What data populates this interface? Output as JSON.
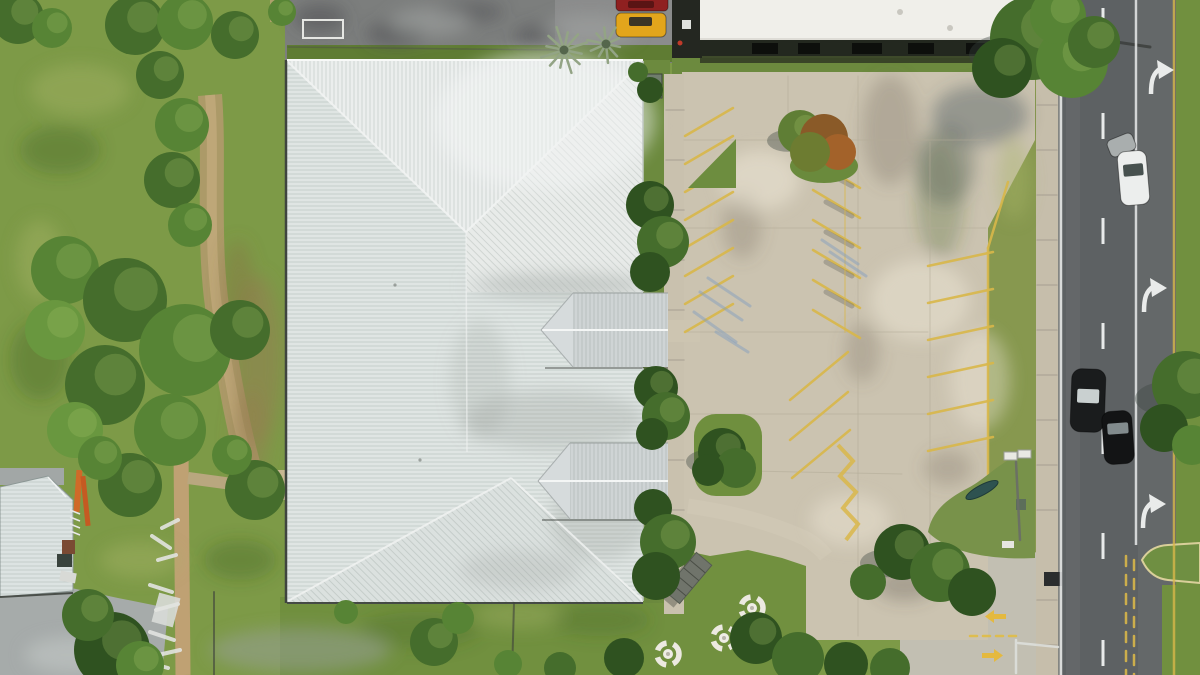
{
  "scene": {
    "colors": {
      "grass_field": "#7d9a47",
      "grass_verge": "#87984f",
      "grass_island": "#6f8f3e",
      "tree_dark": "#2f5220",
      "tree_mid": "#456d2c",
      "tree_light": "#69973f",
      "tree_rust": "#8a5a28",
      "roof_metal": "#dfe5e3",
      "roof_dormer": "#cfd4d5",
      "roof_left_building": "#dce3e2",
      "building_white": "#f0efea",
      "concrete_lot": "#cbc3b0",
      "concrete_walk": "#c6beab",
      "asphalt_old": "#7c7e7d",
      "asphalt_road": "#5d6163",
      "stripe_yellow": "#d9b74a",
      "marking_white": "#e8eaea",
      "car_red": "#8f2020",
      "car_yellow": "#e2a51c",
      "car_white": "#eceeed",
      "car_black": "#1a1c1d",
      "ladder_orange": "#d06a28"
    },
    "trees": [
      [
        18,
        18,
        26,
        "#456d2c",
        ""
      ],
      [
        52,
        28,
        20,
        "#578435",
        ""
      ],
      [
        135,
        25,
        30,
        "#456d2c",
        ""
      ],
      [
        185,
        22,
        28,
        "#578435",
        ""
      ],
      [
        235,
        35,
        24,
        "#456d2c",
        ""
      ],
      [
        282,
        12,
        14,
        "#578435",
        ""
      ],
      [
        160,
        75,
        24,
        "#456d2c",
        ""
      ],
      [
        182,
        125,
        27,
        "#578435",
        ""
      ],
      [
        172,
        180,
        28,
        "#456d2c",
        ""
      ],
      [
        190,
        225,
        22,
        "#578435",
        ""
      ],
      [
        65,
        270,
        34,
        "#578435",
        ""
      ],
      [
        125,
        300,
        42,
        "#456d2c",
        ""
      ],
      [
        55,
        330,
        30,
        "#69973f",
        ""
      ],
      [
        185,
        350,
        46,
        "#578435",
        ""
      ],
      [
        105,
        385,
        40,
        "#456d2c",
        ""
      ],
      [
        170,
        430,
        36,
        "#578435",
        ""
      ],
      [
        75,
        430,
        28,
        "#69973f",
        ""
      ],
      [
        240,
        330,
        30,
        "#456d2c",
        ""
      ],
      [
        255,
        490,
        30,
        "#456d2c",
        ""
      ],
      [
        232,
        455,
        20,
        "#578435",
        ""
      ],
      [
        130,
        485,
        32,
        "#456d2c",
        ""
      ],
      [
        100,
        458,
        22,
        "#578435",
        ""
      ],
      [
        112,
        650,
        38,
        "#2f5220",
        ""
      ],
      [
        88,
        615,
        26,
        "#456d2c",
        ""
      ],
      [
        140,
        665,
        24,
        "#578435",
        ""
      ],
      [
        650,
        90,
        13,
        "#2f5220",
        "n"
      ],
      [
        638,
        72,
        10,
        "#456d2c",
        "n"
      ],
      [
        650,
        205,
        24,
        "#2f5220",
        ""
      ],
      [
        663,
        242,
        26,
        "#456d2c",
        ""
      ],
      [
        650,
        272,
        20,
        "#2f5220",
        "n"
      ],
      [
        656,
        388,
        22,
        "#2f5220",
        ""
      ],
      [
        666,
        416,
        24,
        "#456d2c",
        ""
      ],
      [
        652,
        434,
        16,
        "#2f5220",
        "n"
      ],
      [
        653,
        508,
        19,
        "#2f5220",
        "n"
      ],
      [
        668,
        542,
        28,
        "#456d2c",
        ""
      ],
      [
        656,
        576,
        24,
        "#2f5220",
        "n"
      ],
      [
        800,
        132,
        22,
        "#5f7e35",
        "s"
      ],
      [
        824,
        138,
        24,
        "#8a5a28",
        "n"
      ],
      [
        838,
        152,
        18,
        "#a3622a",
        "n"
      ],
      [
        810,
        152,
        20,
        "#6d7c31",
        "n"
      ],
      [
        722,
        452,
        24,
        "#2f5220",
        "s"
      ],
      [
        736,
        468,
        20,
        "#456d2c",
        "n"
      ],
      [
        708,
        470,
        16,
        "#2f5220",
        "n"
      ],
      [
        1032,
        38,
        42,
        "#456d2c",
        "s"
      ],
      [
        1072,
        62,
        36,
        "#578435",
        ""
      ],
      [
        1002,
        68,
        30,
        "#2f5220",
        ""
      ],
      [
        1058,
        16,
        28,
        "#578435",
        ""
      ],
      [
        1094,
        42,
        26,
        "#456d2c",
        ""
      ],
      [
        902,
        552,
        28,
        "#2f5220",
        "s"
      ],
      [
        940,
        572,
        30,
        "#456d2c",
        ""
      ],
      [
        972,
        592,
        24,
        "#2f5220",
        "n"
      ],
      [
        868,
        582,
        18,
        "#456d2c",
        "n"
      ],
      [
        1186,
        385,
        34,
        "#456d2c",
        "s"
      ],
      [
        1164,
        428,
        24,
        "#2f5220",
        "n"
      ],
      [
        1192,
        445,
        20,
        "#578435",
        "n"
      ],
      [
        624,
        658,
        20,
        "#2f5220",
        "n"
      ],
      [
        560,
        668,
        16,
        "#456d2c",
        "n"
      ],
      [
        756,
        638,
        26,
        "#2f5220",
        ""
      ],
      [
        798,
        658,
        26,
        "#456d2c",
        "n"
      ],
      [
        846,
        664,
        22,
        "#2f5220",
        "n"
      ],
      [
        890,
        668,
        20,
        "#456d2c",
        "n"
      ],
      [
        434,
        642,
        24,
        "#456d2c",
        ""
      ],
      [
        458,
        618,
        16,
        "#578435",
        "n"
      ],
      [
        346,
        612,
        12,
        "#578435",
        "n"
      ],
      [
        508,
        664,
        14,
        "#578435",
        "n"
      ]
    ],
    "palms": [
      [
        564,
        50,
        24,
        12
      ],
      [
        606,
        44,
        19,
        10
      ]
    ],
    "tables": [
      [
        752,
        608
      ],
      [
        724,
        638
      ],
      [
        668,
        654
      ]
    ],
    "cars": [
      {
        "x": 616,
        "y": -5,
        "w": 52,
        "h": 16,
        "rx": 4,
        "rot": 0,
        "body": "#8f2020",
        "win": [
          628,
          1,
          26,
          7,
          "#5a1414"
        ]
      },
      {
        "x": 616,
        "y": 13,
        "w": 50,
        "h": 24,
        "rx": 5,
        "rot": 0,
        "body": "#e2a51c",
        "win": [
          629,
          17,
          23,
          9,
          "#3a3426"
        ]
      },
      {
        "x": 1108,
        "y": 136,
        "w": 27,
        "h": 18,
        "rx": 5,
        "rot": -22,
        "body": "#a9aeae",
        "win": null
      },
      {
        "x": 1119,
        "y": 151,
        "w": 29,
        "h": 54,
        "rx": 8,
        "rot": -5,
        "body": "#eceeed",
        "win": [
          1124,
          164,
          20,
          12,
          "#47514f"
        ]
      },
      {
        "x": 1071,
        "y": 369,
        "w": 34,
        "h": 63,
        "rx": 10,
        "rot": 2,
        "body": "#1a1c1d",
        "win": [
          1077,
          389,
          22,
          14,
          "#c9d0d0"
        ]
      },
      {
        "x": 1103,
        "y": 411,
        "w": 30,
        "h": 53,
        "rx": 9,
        "rot": -4,
        "body": "#131415",
        "win": [
          1108,
          423,
          21,
          11,
          "#828b8d"
        ]
      }
    ],
    "windows": [
      [
        752,
        26
      ],
      [
        798,
        22
      ],
      [
        852,
        30
      ],
      [
        908,
        26
      ],
      [
        966,
        20
      ]
    ],
    "road_dash_ys": [
      8,
      113,
      218,
      323,
      428,
      533,
      640
    ],
    "line_groups": [
      {
        "layer": "g-stripes",
        "name": "parking-stripe",
        "c": "#d9b74a",
        "w": 2.5,
        "o": 0.9,
        "lines": [
          [
            685,
            136,
            733,
            108
          ],
          [
            685,
            164,
            733,
            136
          ],
          [
            685,
            192,
            733,
            164
          ],
          [
            685,
            220,
            733,
            192
          ],
          [
            685,
            248,
            733,
            220
          ],
          [
            685,
            276,
            733,
            248
          ],
          [
            685,
            304,
            733,
            276
          ],
          [
            685,
            332,
            733,
            304
          ],
          [
            813,
            160,
            860,
            188
          ],
          [
            813,
            190,
            860,
            218
          ],
          [
            813,
            220,
            860,
            248
          ],
          [
            813,
            250,
            860,
            278
          ],
          [
            813,
            280,
            860,
            308
          ],
          [
            813,
            310,
            860,
            338
          ],
          [
            790,
            400,
            848,
            352
          ],
          [
            790,
            440,
            848,
            392
          ],
          [
            792,
            478,
            850,
            430
          ],
          [
            928,
            266,
            993,
            252
          ],
          [
            928,
            303,
            993,
            289
          ],
          [
            928,
            340,
            993,
            326
          ],
          [
            928,
            377,
            993,
            363
          ],
          [
            928,
            414,
            993,
            400
          ],
          [
            928,
            451,
            993,
            437
          ],
          [
            1008,
            182,
            988,
            248
          ],
          [
            988,
            248,
            988,
            540
          ]
        ]
      },
      {
        "layer": "g-stripes",
        "name": "tire-mark",
        "c": "#6e6e66",
        "w": 5,
        "o": 0.4,
        "lines": [
          [
            826,
            172,
            852,
            186
          ],
          [
            826,
            202,
            852,
            216
          ],
          [
            826,
            232,
            852,
            246
          ],
          [
            826,
            262,
            852,
            276
          ],
          [
            826,
            292,
            852,
            306
          ]
        ]
      },
      {
        "layer": "g-stripes",
        "name": "parking-stripe-faint",
        "c": "#d9b74a",
        "w": 2,
        "o": 0.4,
        "lines": [
          [
            845,
            140,
            845,
            332
          ]
        ]
      },
      {
        "layer": "g-stripes",
        "name": "faded-blue-paint",
        "c": "#7f9cc0",
        "w": 3,
        "o": 0.45,
        "lines": [
          [
            700,
            292,
            742,
            320
          ],
          [
            694,
            312,
            736,
            342
          ],
          [
            708,
            278,
            750,
            306
          ],
          [
            716,
            332,
            748,
            352
          ],
          [
            822,
            240,
            858,
            264
          ],
          [
            830,
            252,
            866,
            276
          ]
        ]
      },
      {
        "layer": "g-lines-low",
        "name": "concrete-joint",
        "c": "#b3ab98",
        "w": 1,
        "o": 0.55,
        "lines": [
          [
            858,
            76,
            858,
            636
          ],
          [
            930,
            142,
            930,
            596
          ],
          [
            684,
            140,
            986,
            140
          ],
          [
            684,
            228,
            986,
            228
          ],
          [
            686,
            332,
            928,
            332
          ],
          [
            686,
            414,
            928,
            414
          ],
          [
            700,
            470,
            902,
            474
          ],
          [
            788,
            76,
            788,
            138
          ]
        ]
      },
      {
        "layer": "g-lines-low",
        "name": "sidewalk-joint",
        "c": "#a8a193",
        "w": 1.5,
        "o": 0.7,
        "lines": [
          [
            666,
            110,
            684,
            110
          ],
          [
            666,
            160,
            684,
            160
          ],
          [
            666,
            210,
            684,
            210
          ],
          [
            666,
            260,
            684,
            260
          ],
          [
            666,
            310,
            684,
            310
          ],
          [
            666,
            360,
            684,
            360
          ],
          [
            666,
            410,
            684,
            410
          ],
          [
            666,
            460,
            684,
            460
          ],
          [
            666,
            510,
            684,
            510
          ],
          [
            666,
            560,
            684,
            560
          ],
          [
            1037,
            105,
            1057,
            105
          ],
          [
            1037,
            150,
            1057,
            150
          ],
          [
            1037,
            195,
            1057,
            195
          ],
          [
            1037,
            240,
            1057,
            240
          ],
          [
            1037,
            285,
            1057,
            285
          ],
          [
            1037,
            330,
            1057,
            330
          ],
          [
            1037,
            375,
            1057,
            375
          ],
          [
            1037,
            420,
            1057,
            420
          ],
          [
            1037,
            465,
            1057,
            465
          ],
          [
            1037,
            510,
            1057,
            510
          ],
          [
            1037,
            600,
            1057,
            600
          ],
          [
            1037,
            645,
            1057,
            645
          ]
        ]
      },
      {
        "layer": "g-lines-low",
        "name": "fence-line",
        "c": "#4e5148",
        "w": 1.5,
        "o": 0.5,
        "lines": [
          [
            288,
            47,
            558,
            50
          ]
        ]
      },
      {
        "layer": "g-lines-low",
        "name": "streetlight-arm",
        "c": "#3a3d3a",
        "w": 3,
        "o": 0.8,
        "lines": [
          [
            1103,
            40,
            1150,
            47
          ]
        ]
      },
      {
        "layer": "g-lines-high",
        "name": "pole-shadow",
        "c": "#3f423c",
        "w": 2,
        "o": 0.6,
        "lines": [
          [
            514,
            603,
            512,
            675
          ],
          [
            214,
            592,
            214,
            675
          ]
        ]
      },
      {
        "layer": "g-lines-high",
        "name": "debris",
        "c": "#e3e4e0",
        "w": 4,
        "o": 0.9,
        "lines": [
          [
            152,
            536,
            170,
            548
          ],
          [
            158,
            560,
            176,
            555
          ],
          [
            150,
            585,
            172,
            592
          ],
          [
            156,
            610,
            178,
            604
          ],
          [
            150,
            632,
            174,
            640
          ],
          [
            158,
            655,
            180,
            650
          ],
          [
            162,
            528,
            178,
            520
          ],
          [
            146,
            662,
            168,
            668
          ]
        ]
      },
      {
        "layer": "g-lines-high",
        "name": "lamp-pole",
        "c": "#6a6d68",
        "w": 2.5,
        "o": 0.9,
        "lines": [
          [
            1016,
            462,
            1020,
            540
          ]
        ]
      },
      {
        "layer": "g-lines-high",
        "name": "road-center-dashes-yellow",
        "c": "#d9b74a",
        "w": 2.5,
        "o": 0.9,
        "dash": "10 9",
        "lines": [
          [
            1126,
            556,
            1126,
            675
          ],
          [
            1134,
            560,
            1134,
            675
          ]
        ]
      },
      {
        "layer": "g-lines-high",
        "name": "driveway-dash-yellow",
        "c": "#e0bd45",
        "w": 2.5,
        "o": 0.9,
        "dash": "7 6",
        "lines": [
          [
            970,
            636,
            1018,
            636
          ]
        ]
      },
      {
        "layer": "g-lines-high",
        "name": "driveway-line-white",
        "c": "#dfe1dd",
        "w": 2.5,
        "o": 0.85,
        "lines": [
          [
            1016,
            640,
            1016,
            673
          ],
          [
            1018,
            643,
            1058,
            647
          ]
        ]
      }
    ]
  }
}
